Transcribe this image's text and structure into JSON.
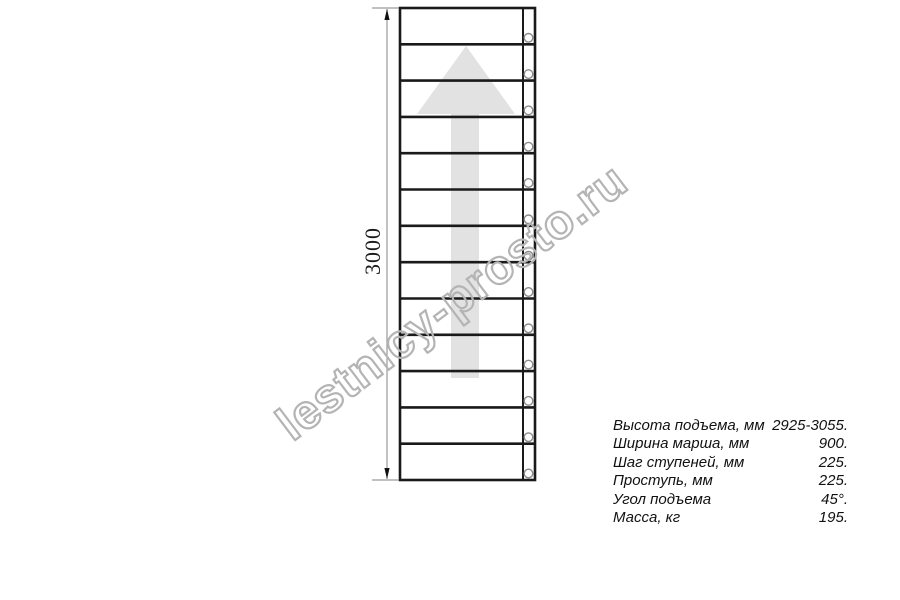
{
  "drawing": {
    "dimension_label": "3000",
    "watermark_text": "lestnicy-prosto.ru",
    "steps_count": 13,
    "colors": {
      "line": "#1a1a1a",
      "dimension_line": "#9a9a9a",
      "arrow_fill": "#e2e2e2",
      "watermark_stroke": "#b4b4b4",
      "hole_stroke": "#8a8a8a"
    }
  },
  "specs": {
    "rows": [
      {
        "label": "Высота подъема, мм",
        "value": "2925-3055."
      },
      {
        "label": "Ширина марша, мм",
        "value": "900."
      },
      {
        "label": "Шаг ступеней, мм",
        "value": "225."
      },
      {
        "label": "Проступь, мм",
        "value": "225."
      },
      {
        "label": "Угол подъема",
        "value": "45°."
      },
      {
        "label": "Масса, кг",
        "value": "195."
      }
    ]
  }
}
